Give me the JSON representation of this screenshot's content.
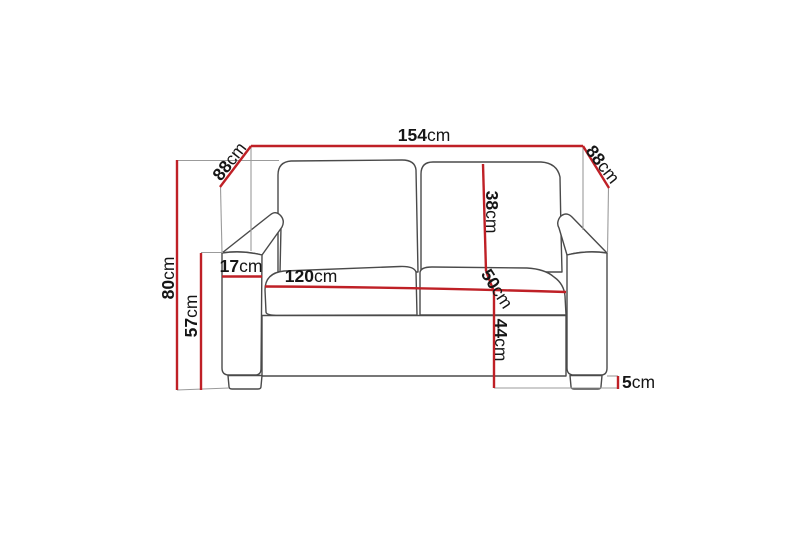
{
  "diagram": {
    "subject": "two-seater sofa dimension drawing",
    "unit": "cm",
    "colors": {
      "background": "#ffffff",
      "dimension_line": "#bf2026",
      "sofa_outline": "#4a4a4a",
      "extension_line": "#9b9b9b",
      "label_text": "#161616"
    },
    "dimensions": [
      {
        "name": "overall-width",
        "value": "154",
        "unit": "cm"
      },
      {
        "name": "depth-left",
        "value": "88",
        "unit": "cm"
      },
      {
        "name": "depth-right",
        "value": "88",
        "unit": "cm"
      },
      {
        "name": "overall-height",
        "value": "80",
        "unit": "cm"
      },
      {
        "name": "armrest-height",
        "value": "57",
        "unit": "cm"
      },
      {
        "name": "armrest-width",
        "value": "17",
        "unit": "cm"
      },
      {
        "name": "seat-width",
        "value": "120",
        "unit": "cm"
      },
      {
        "name": "backrest-cushion-height",
        "value": "38",
        "unit": "cm"
      },
      {
        "name": "seat-depth",
        "value": "50",
        "unit": "cm"
      },
      {
        "name": "seat-height",
        "value": "44",
        "unit": "cm"
      },
      {
        "name": "leg-height",
        "value": "5",
        "unit": "cm"
      }
    ]
  }
}
